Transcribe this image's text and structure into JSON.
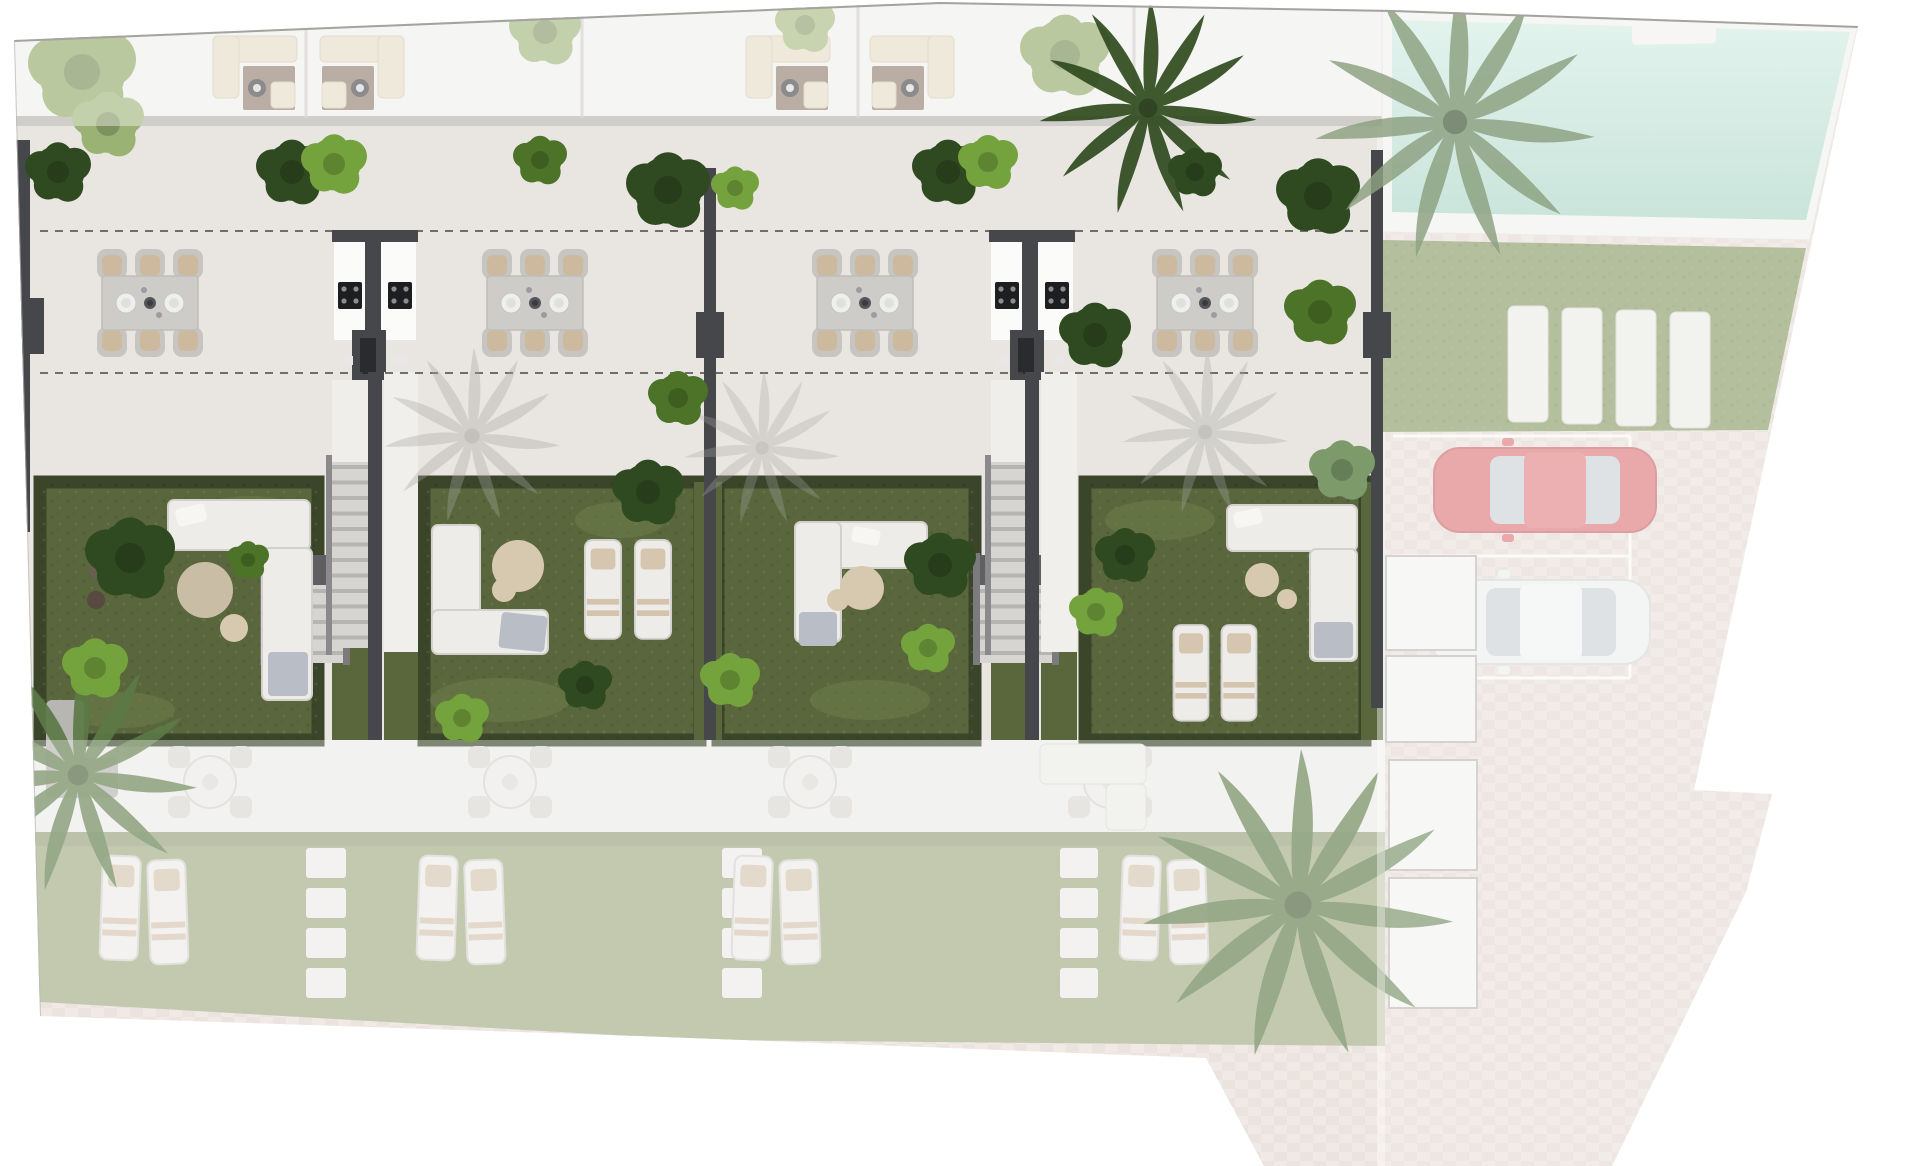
{
  "meta": {
    "title": "Residential development site plan",
    "view": "top-down architectural rendering",
    "highlighted_area": "ground-floor terraces and private gardens of four townhouses"
  },
  "colors": {
    "page_bg": "#ffffff",
    "roof_band": "#efeeec",
    "terrace": "#e9e6e1",
    "lower_terrace": "#ecebe8",
    "garden": "#5a673d",
    "garden_patch": "#6e7d49",
    "hedge": "#3a452a",
    "lawn_pool": "#7e9157",
    "lawn_lower": "#a3ad85",
    "pool_top": "#cfeae1",
    "pool_bottom": "#a3d2c2",
    "deck": "#f0efec",
    "paver_a": "#e9ded7",
    "paver_b": "#e1d5cd",
    "wall_dark": "#46474a",
    "wall_gray": "#a3a19e",
    "kitchen_white": "#fbfbfa",
    "cooktop": "#1d1e20",
    "step_light": "#d7d5d1",
    "step_shade": "#b7b5b1",
    "white_furniture": "#edece8",
    "furniture_stroke": "#d3d1cd",
    "cushion_tan": "#cdb99e",
    "pouf": "#d7c9b0",
    "blanket_gray": "#b9bdc6",
    "table_gray": "#ceccc8",
    "chair_gray": "#c7c5c2",
    "roof_sofa": "#e3dac2",
    "roof_rug": "#8d7767",
    "car_red": "#d9696d",
    "car_red_roof": "#de777b",
    "car_white": "#ebecec",
    "car_glass": "#c9ced3",
    "plant_dark": "#2f4a20",
    "plant_mid": "#4c7328",
    "plant_light": "#74a23c",
    "plant_sage": "#7d9a6b",
    "palm_ghost": "#5c7a46",
    "palm_muted": "#8ca181",
    "shadow": "#a8a6a3",
    "dash": "#474747",
    "stone": "#edece9",
    "line_white": "#f8f7f5",
    "porch": "#f2f1ef",
    "porch_stroke": "#b5b3b1"
  },
  "site": {
    "townhouse_units": [
      {
        "id": "unit-1",
        "terrace": {
          "dining_table_seats": 6,
          "dashed_setback_lines": 2
        },
        "garden": {
          "furniture": [
            "L-shaped lounge sofa",
            "large round pouf",
            "small round pouf",
            "fire bowl"
          ],
          "planting": [
            "dark shrub",
            "light shrub"
          ]
        }
      },
      {
        "id": "unit-2",
        "terrace": {
          "dining_table_seats": 6,
          "dashed_setback_lines": 2
        },
        "garden": {
          "furniture": [
            "L-shaped lounge sofa with chaise",
            "round pouf",
            "2 sun loungers"
          ],
          "planting": [
            "dark shrub",
            "spiky shrub",
            "light shrub"
          ]
        }
      },
      {
        "id": "unit-3",
        "terrace": {
          "dining_table_seats": 6,
          "dashed_setback_lines": 2
        },
        "garden": {
          "furniture": [
            "corner lounge sofa",
            "round pouf",
            "small pouf"
          ],
          "planting": [
            "light shrub",
            "dark shrub"
          ]
        }
      },
      {
        "id": "unit-4",
        "terrace": {
          "dining_table_seats": 6,
          "dashed_setback_lines": 2
        },
        "garden": {
          "furniture": [
            "L-shaped lounge sofa",
            "large round pouf",
            "small round pouf",
            "2 sun loungers"
          ],
          "planting": [
            "sage shrub",
            "light shrub",
            "dark shrub"
          ]
        }
      }
    ],
    "shared_elements": {
      "outdoor_kitchen_modules": 2,
      "cooktops_per_module": 2,
      "garden_staircases": 2,
      "partition_walls": 2,
      "roof_terrace_lounge_sets": 4
    },
    "pool_area": {
      "pool": "rectangular swimming pool",
      "deck": "white pool deck",
      "lawn_loungers": 4,
      "palm_trees": 1
    },
    "parking_area": {
      "marked_spaces": 3,
      "vehicles": [
        {
          "type": "car",
          "color_name": "red"
        },
        {
          "type": "car",
          "color_name": "white"
        }
      ],
      "paving": "brick pavers"
    },
    "lower_row_ghosted": {
      "units": 4,
      "per_unit": [
        "round bistro table with 4 chairs",
        "2 sun loungers on lawn",
        "stepping stone path"
      ],
      "extras": [
        "gray corner sofa far left",
        "white corner sofa right",
        "2 staircases"
      ]
    },
    "vegetation": {
      "palm_trees_total": 4,
      "round_trees_and_shrubs": "numerous, vivid on highlighted level, faded elsewhere"
    }
  }
}
